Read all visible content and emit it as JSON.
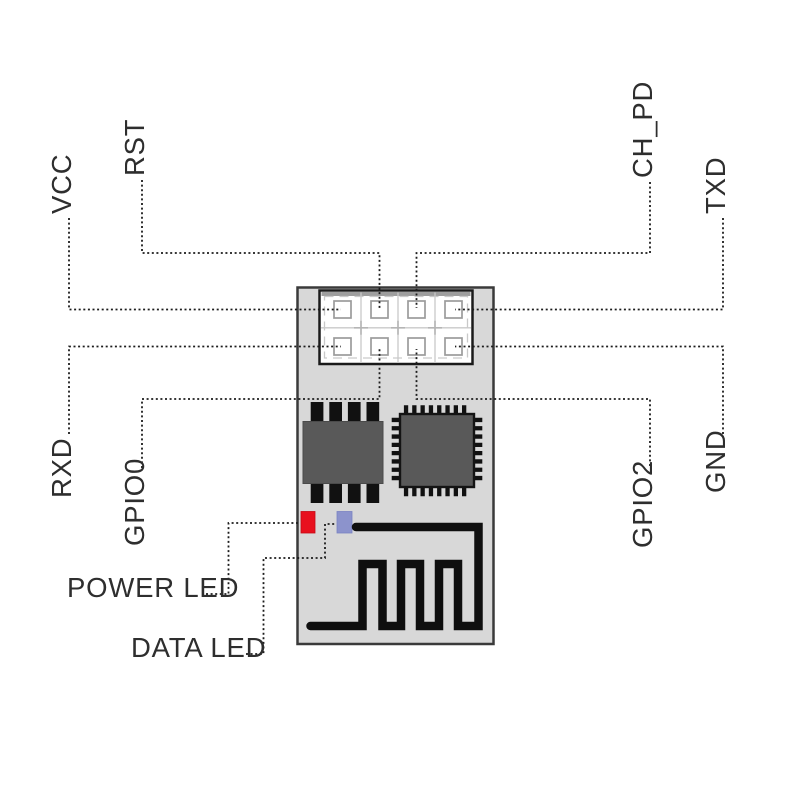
{
  "pins": {
    "vcc": {
      "label": "VCC"
    },
    "rst": {
      "label": "RST"
    },
    "ch_pd": {
      "label": "CH_PD"
    },
    "txd": {
      "label": "TXD"
    },
    "rxd": {
      "label": "RXD"
    },
    "gpio0": {
      "label": "GPIO0"
    },
    "gpio2": {
      "label": "GPIO2"
    },
    "gnd": {
      "label": "GND"
    }
  },
  "leds": {
    "power": {
      "label": "POWER LED"
    },
    "data": {
      "label": "DATA LED"
    }
  },
  "colors": {
    "background": "#ffffff",
    "pcb": "#d8d8d8",
    "pcb_border": "#3a3a3a",
    "header_fill": "#ffffff",
    "pad_outline": "#9b9b9b",
    "chip": "#595959",
    "antenna": "#0f0f0f",
    "leader_line": "#1c1c1c",
    "label_text": "#2e2e2e",
    "power_led": "#e8101e",
    "data_led": "#8c93cc"
  }
}
